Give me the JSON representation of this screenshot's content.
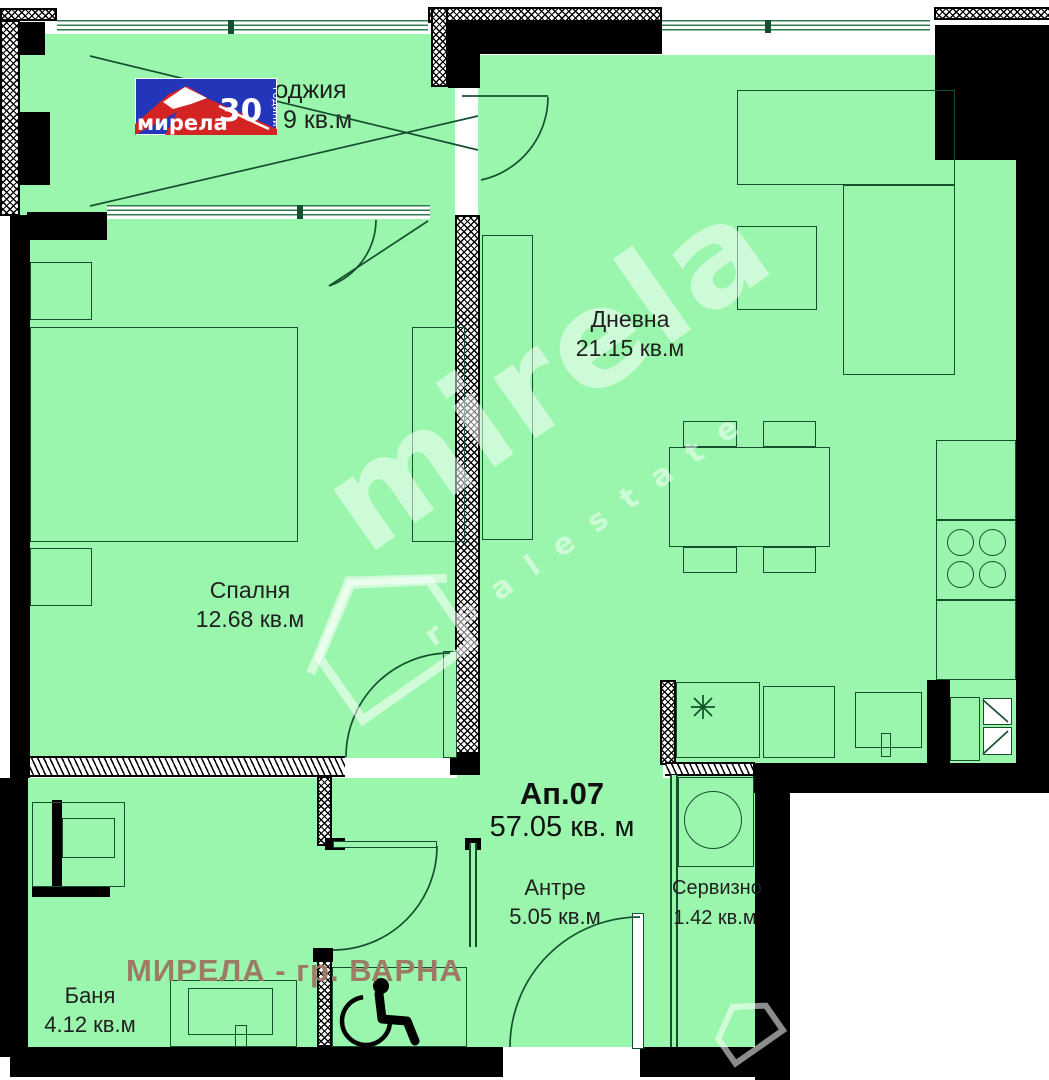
{
  "plan": {
    "apartment_label": "Ап.07",
    "apartment_area": "57.05 кв. м",
    "footer": "МИРЕЛА - гр. ВАРНА",
    "rooms": {
      "loggia": {
        "name": "Лоджия",
        "area": "9 кв.м"
      },
      "living": {
        "name": "Дневна",
        "area": "21.15 кв.м"
      },
      "bedroom": {
        "name": "Спалня",
        "area": "12.68 кв.м"
      },
      "bathroom": {
        "name": "Баня",
        "area": "4.12 кв.м"
      },
      "hall": {
        "name": "Антре",
        "area": "5.05 кв.м"
      },
      "service": {
        "name": "Сервизно",
        "area": "1.42 кв.м"
      }
    }
  },
  "logo": {
    "brand": "мирела",
    "years": "30",
    "years_word": "години"
  },
  "watermark": {
    "brand": "mirela",
    "tagline": "r e a l   e s t a t e"
  },
  "colors": {
    "room_fill": "#9AF6AC",
    "wall": "#000000",
    "plan_line": "#15502e",
    "logo_blue": "#2335B8",
    "logo_red": "#D42323",
    "footer_text": "#9D7A66"
  }
}
